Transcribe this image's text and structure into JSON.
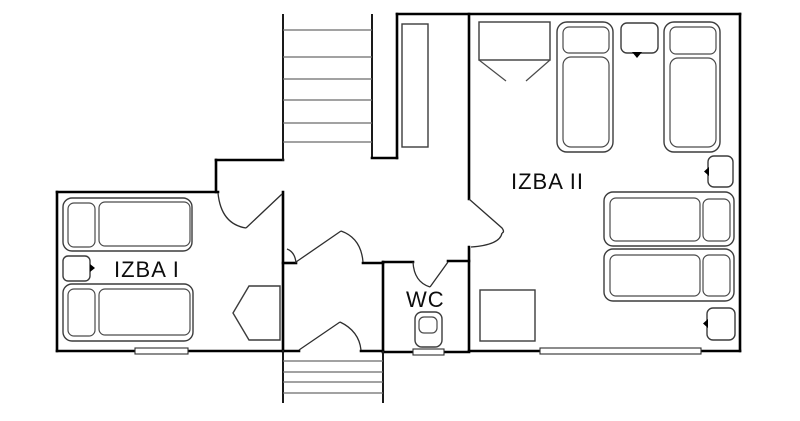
{
  "diagram": {
    "type": "floor-plan",
    "background_color": "#ffffff",
    "wall_color": "#000000",
    "furniture_line_color": "#3c3c3c",
    "labels": {
      "room1": "IZBA I",
      "room2": "IZBA II",
      "wc": "WC"
    },
    "rooms": [
      {
        "id": "izba-1",
        "label": "IZBA I",
        "furniture": [
          "single bed",
          "single bed",
          "nightstand",
          "wardrobe (open)"
        ]
      },
      {
        "id": "izba-2",
        "label": "IZBA II",
        "furniture": [
          "wardrobe (open)",
          "single bed",
          "nightstand",
          "single bed",
          "nightstand",
          "single bed",
          "single bed",
          "nightstand",
          "square table"
        ]
      },
      {
        "id": "wc",
        "label": "WC",
        "furniture": [
          "toilet"
        ]
      },
      {
        "id": "hall",
        "label": "",
        "furniture": [
          "tall wardrobe"
        ]
      }
    ],
    "stairs": [
      {
        "id": "stairs-upper",
        "steps_visible": 6
      },
      {
        "id": "stairs-lower",
        "steps_visible": 4
      }
    ],
    "windows_visible": 3,
    "doors_visible": 5
  }
}
